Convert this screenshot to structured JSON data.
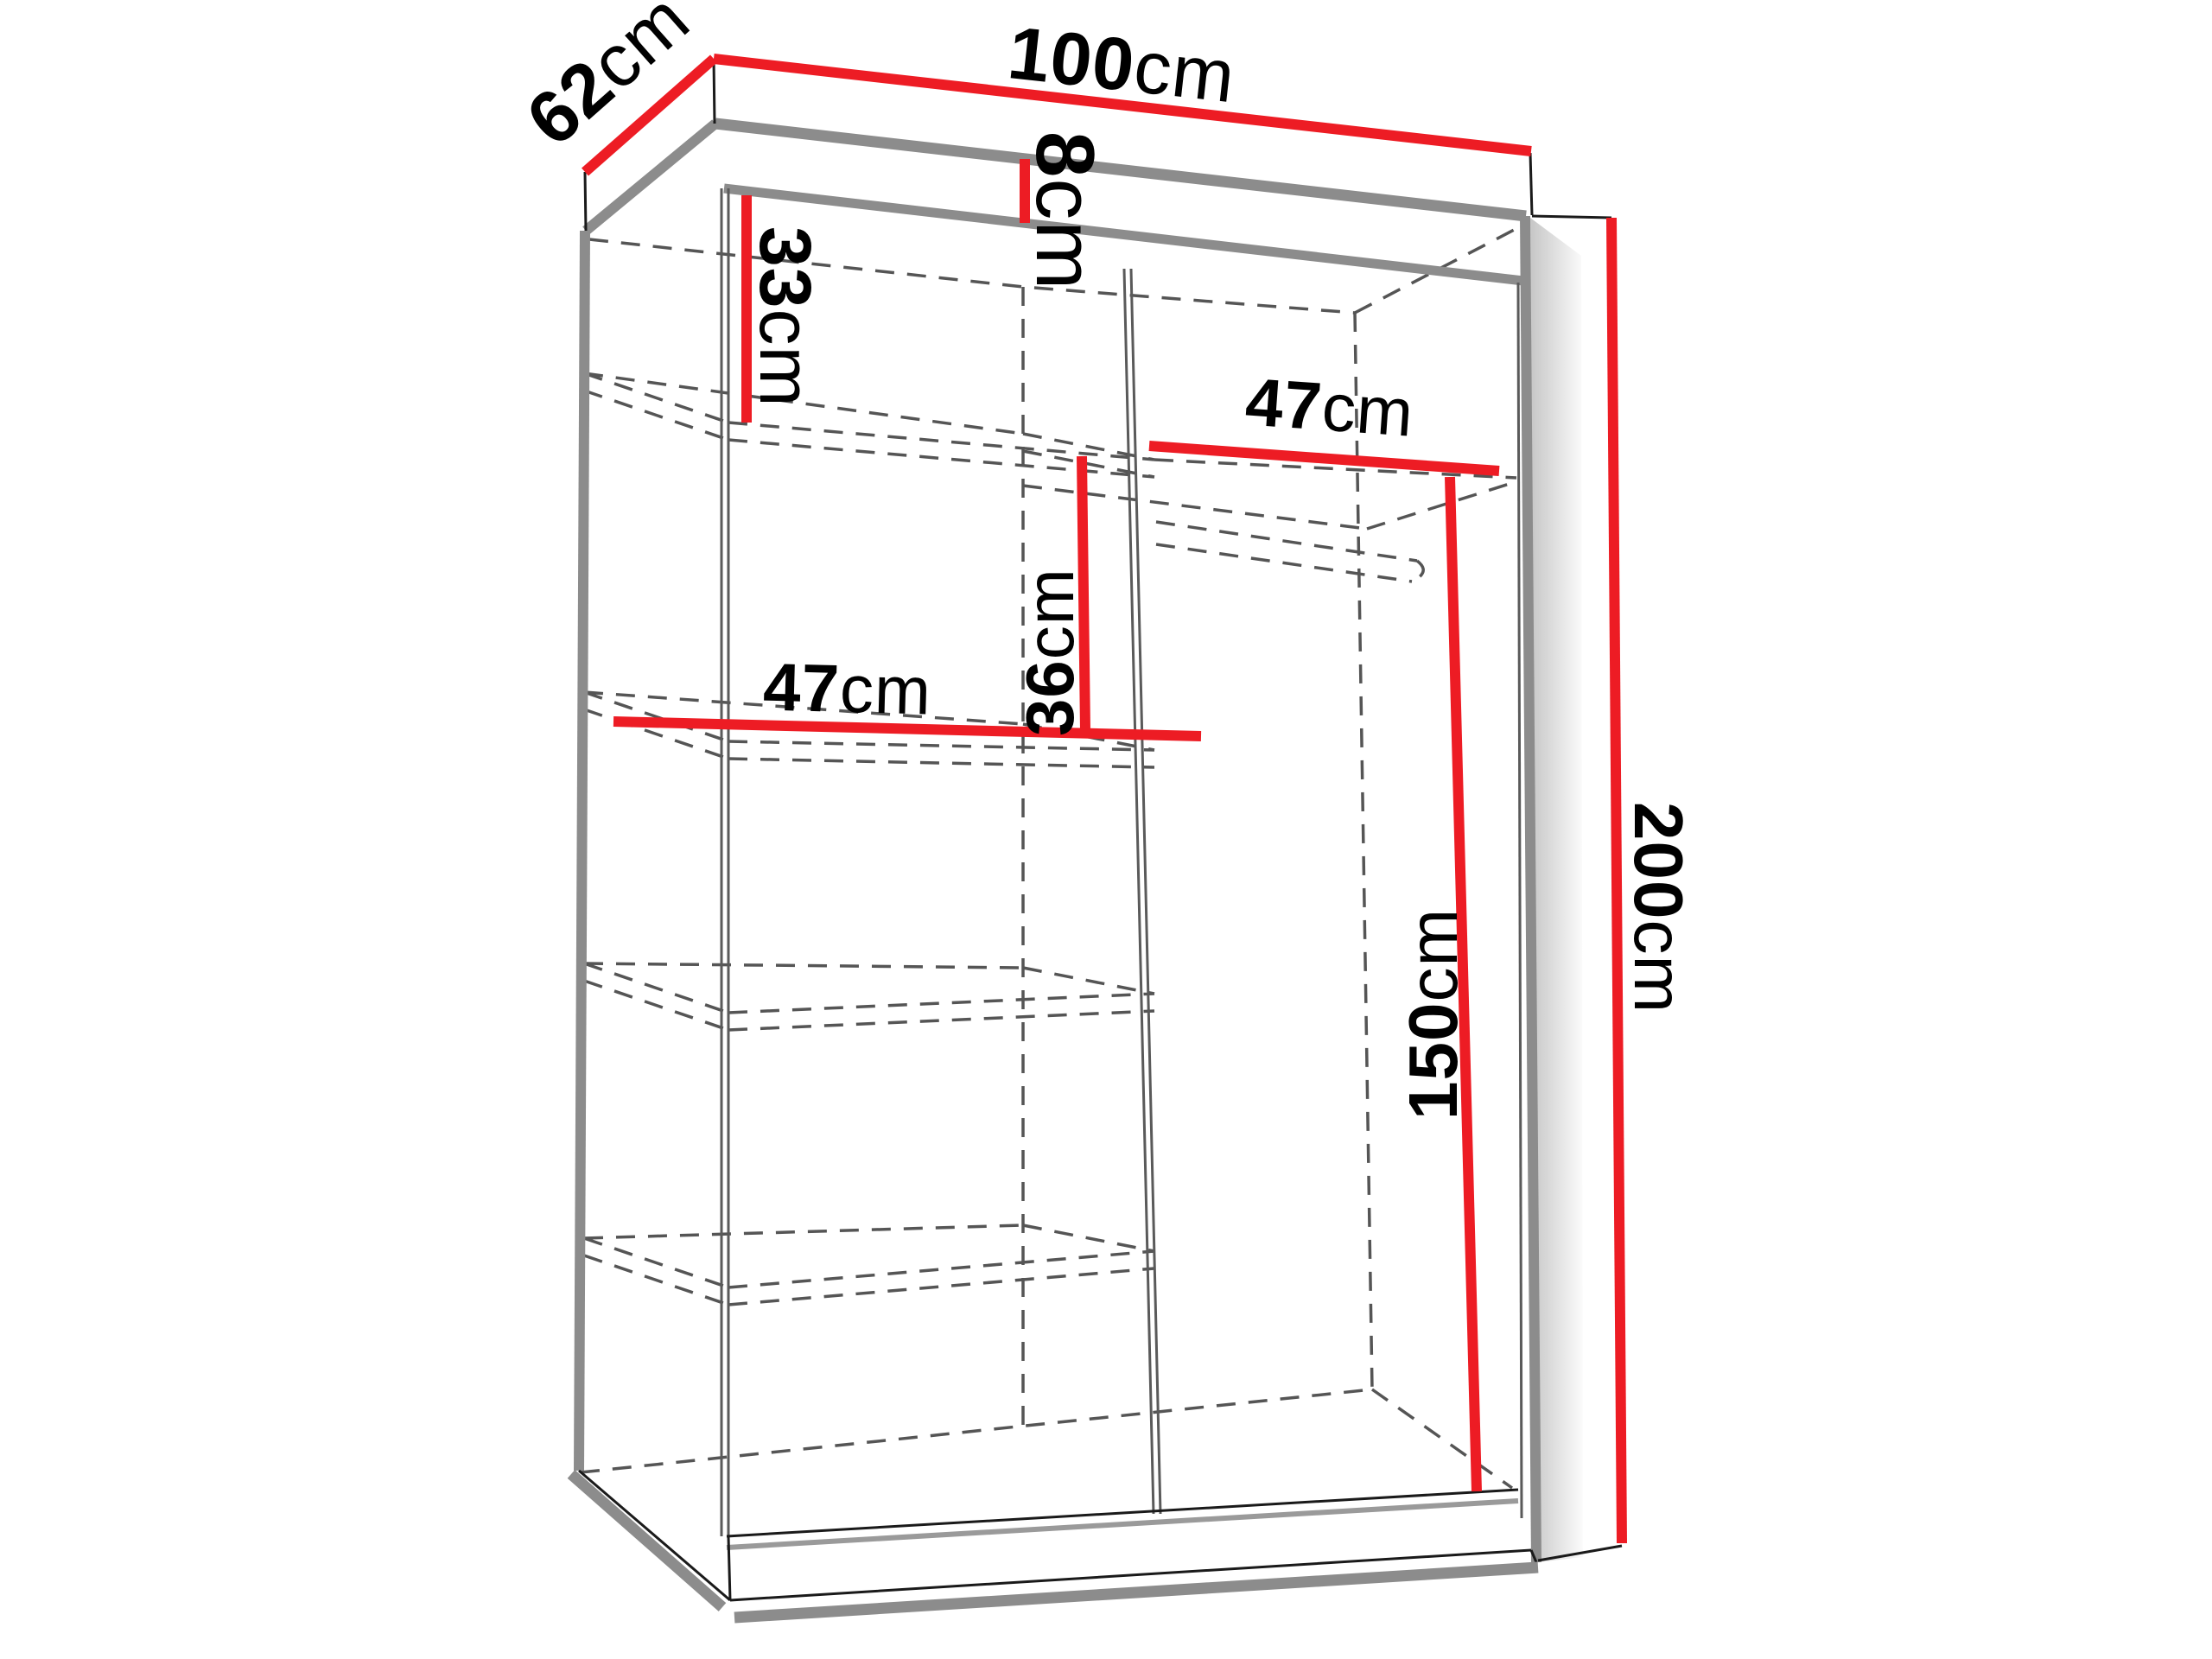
{
  "diagram": {
    "kind": "wardrobe-dimension-drawing",
    "unit": "cm",
    "labels": {
      "width": {
        "value": "100",
        "unit": "cm"
      },
      "depth": {
        "value": "62",
        "unit": "cm"
      },
      "height": {
        "value": "200",
        "unit": "cm"
      },
      "top_panel": {
        "value": "8",
        "unit": "cm"
      },
      "top_section": {
        "value": "33",
        "unit": "cm"
      },
      "right_shelf": {
        "value": "47",
        "unit": "cm"
      },
      "shelf_gap": {
        "value": "36",
        "unit": "cm"
      },
      "left_shelf": {
        "value": "47",
        "unit": "cm"
      },
      "hanging_space": {
        "value": "150",
        "unit": "cm"
      }
    },
    "colors": {
      "dimension_red": "#ed1c24",
      "outline_gray": "#8c8c8c",
      "dash_gray": "#555555",
      "line_black": "#1a1a1a",
      "background": "#ffffff"
    }
  }
}
